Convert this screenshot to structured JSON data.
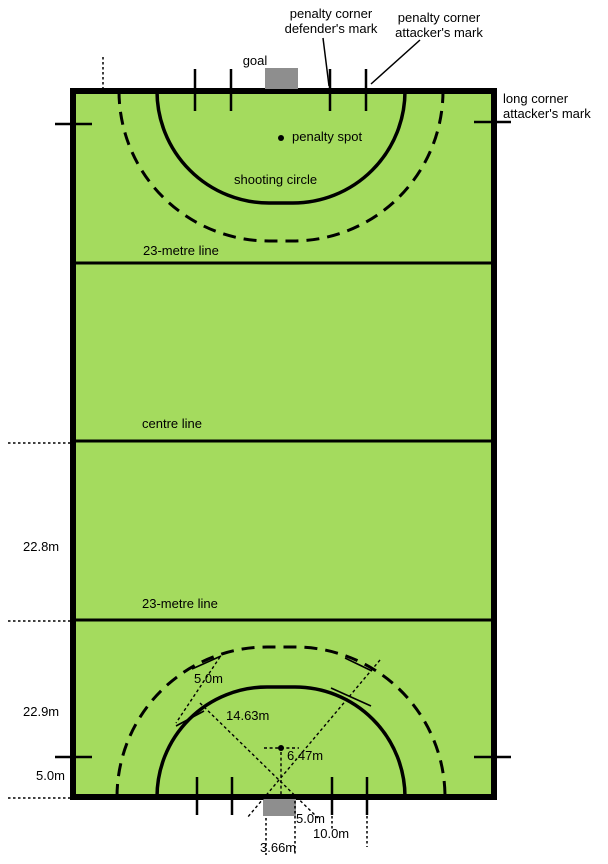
{
  "diagram": {
    "title": "field hockey pitch diagram",
    "colors": {
      "background": "#ffffff",
      "field_green": "#a4db5e",
      "line_black": "#000000",
      "goal_gray": "#8e8e8e"
    },
    "labels": {
      "penalty_corner_defenders_mark": "penalty corner\ndefender's mark",
      "penalty_corner_attackers_mark": "penalty corner\nattacker's mark",
      "goal": "goal",
      "long_corner_attackers_mark": "long corner\nattacker's mark",
      "penalty_spot": "penalty spot",
      "shooting_circle": "shooting circle",
      "metre23_line_upper": "23-metre line",
      "centre_line": "centre line",
      "metre23_line_lower": "23-metre line"
    },
    "measurements": {
      "half_length": "22.8m",
      "defensive_quarter": "22.9m",
      "long_corner_distance": "5.0m",
      "circle_gap": "5.0m",
      "circle_radius": "14.63m",
      "penalty_spot_distance": "6.47m",
      "defender_mark_distance": "5.0m",
      "attacker_mark_distance": "10.0m",
      "goal_width": "3.66m"
    }
  }
}
